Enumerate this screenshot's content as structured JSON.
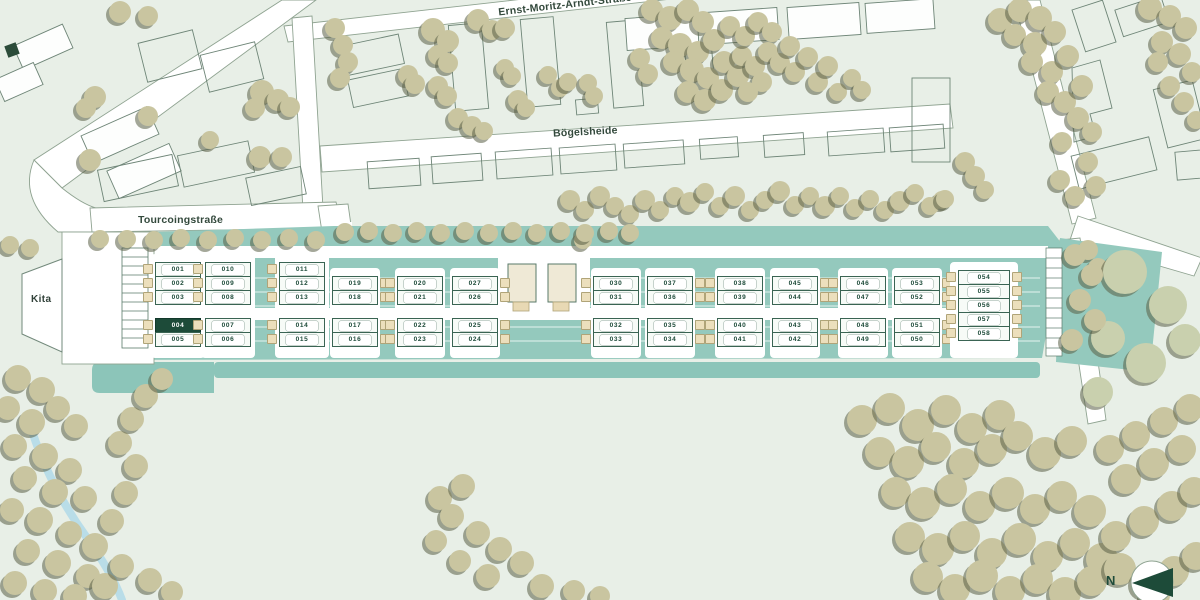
{
  "streets": {
    "top_label": "Ernst-Moritz-Arndt-Straße",
    "middle_label": "Bögelsheide",
    "lower_label": "Tourcoingstraße"
  },
  "kita_label": "Kita",
  "compass_label": "N",
  "selected_plot": "004",
  "colors": {
    "background": "#e8efe7",
    "street": "#ffffff",
    "development_teal": "#94c9bd",
    "hedge_teal": "#8cc5b9",
    "tree_khaki": "#c9c5a0",
    "selected_green": "#1d4b39",
    "garage_beige": "#ecdfbc",
    "stream_blue": "#b9dde8"
  },
  "development": {
    "columns": [
      {
        "x": 178,
        "garage": "left",
        "top": [
          "001",
          "002",
          "003"
        ],
        "bottom": [
          "004",
          "005"
        ]
      },
      {
        "x": 228,
        "garage": "left",
        "top": [
          "010",
          "009",
          "008"
        ],
        "bottom": [
          "007",
          "006"
        ]
      },
      {
        "x": 302,
        "garage": "left",
        "top": [
          "011",
          "012",
          "013"
        ],
        "bottom": [
          "014",
          "015"
        ]
      },
      {
        "x": 355,
        "garage": "right",
        "top": [
          "019",
          "018"
        ],
        "bottom": [
          "017",
          "016"
        ]
      },
      {
        "x": 420,
        "garage": "left",
        "top": [
          "020",
          "021"
        ],
        "bottom": [
          "022",
          "023"
        ]
      },
      {
        "x": 475,
        "garage": "right",
        "top": [
          "027",
          "026"
        ],
        "bottom": [
          "025",
          "024"
        ]
      },
      {
        "x": 616,
        "garage": "left",
        "top": [
          "030",
          "031"
        ],
        "bottom": [
          "032",
          "033"
        ]
      },
      {
        "x": 670,
        "garage": "right",
        "top": [
          "037",
          "036"
        ],
        "bottom": [
          "035",
          "034"
        ]
      },
      {
        "x": 740,
        "garage": "left",
        "top": [
          "038",
          "039"
        ],
        "bottom": [
          "040",
          "041"
        ]
      },
      {
        "x": 795,
        "garage": "right",
        "top": [
          "045",
          "044"
        ],
        "bottom": [
          "043",
          "042"
        ]
      },
      {
        "x": 863,
        "garage": "left",
        "top": [
          "046",
          "047"
        ],
        "bottom": [
          "048",
          "049"
        ]
      },
      {
        "x": 917,
        "garage": "right",
        "top": [
          "053",
          "052"
        ],
        "bottom": [
          "051",
          "050"
        ]
      },
      {
        "x": 984,
        "garage": "both",
        "top": [
          "054",
          "055",
          "056",
          "057",
          "058"
        ],
        "bottom": []
      }
    ]
  }
}
